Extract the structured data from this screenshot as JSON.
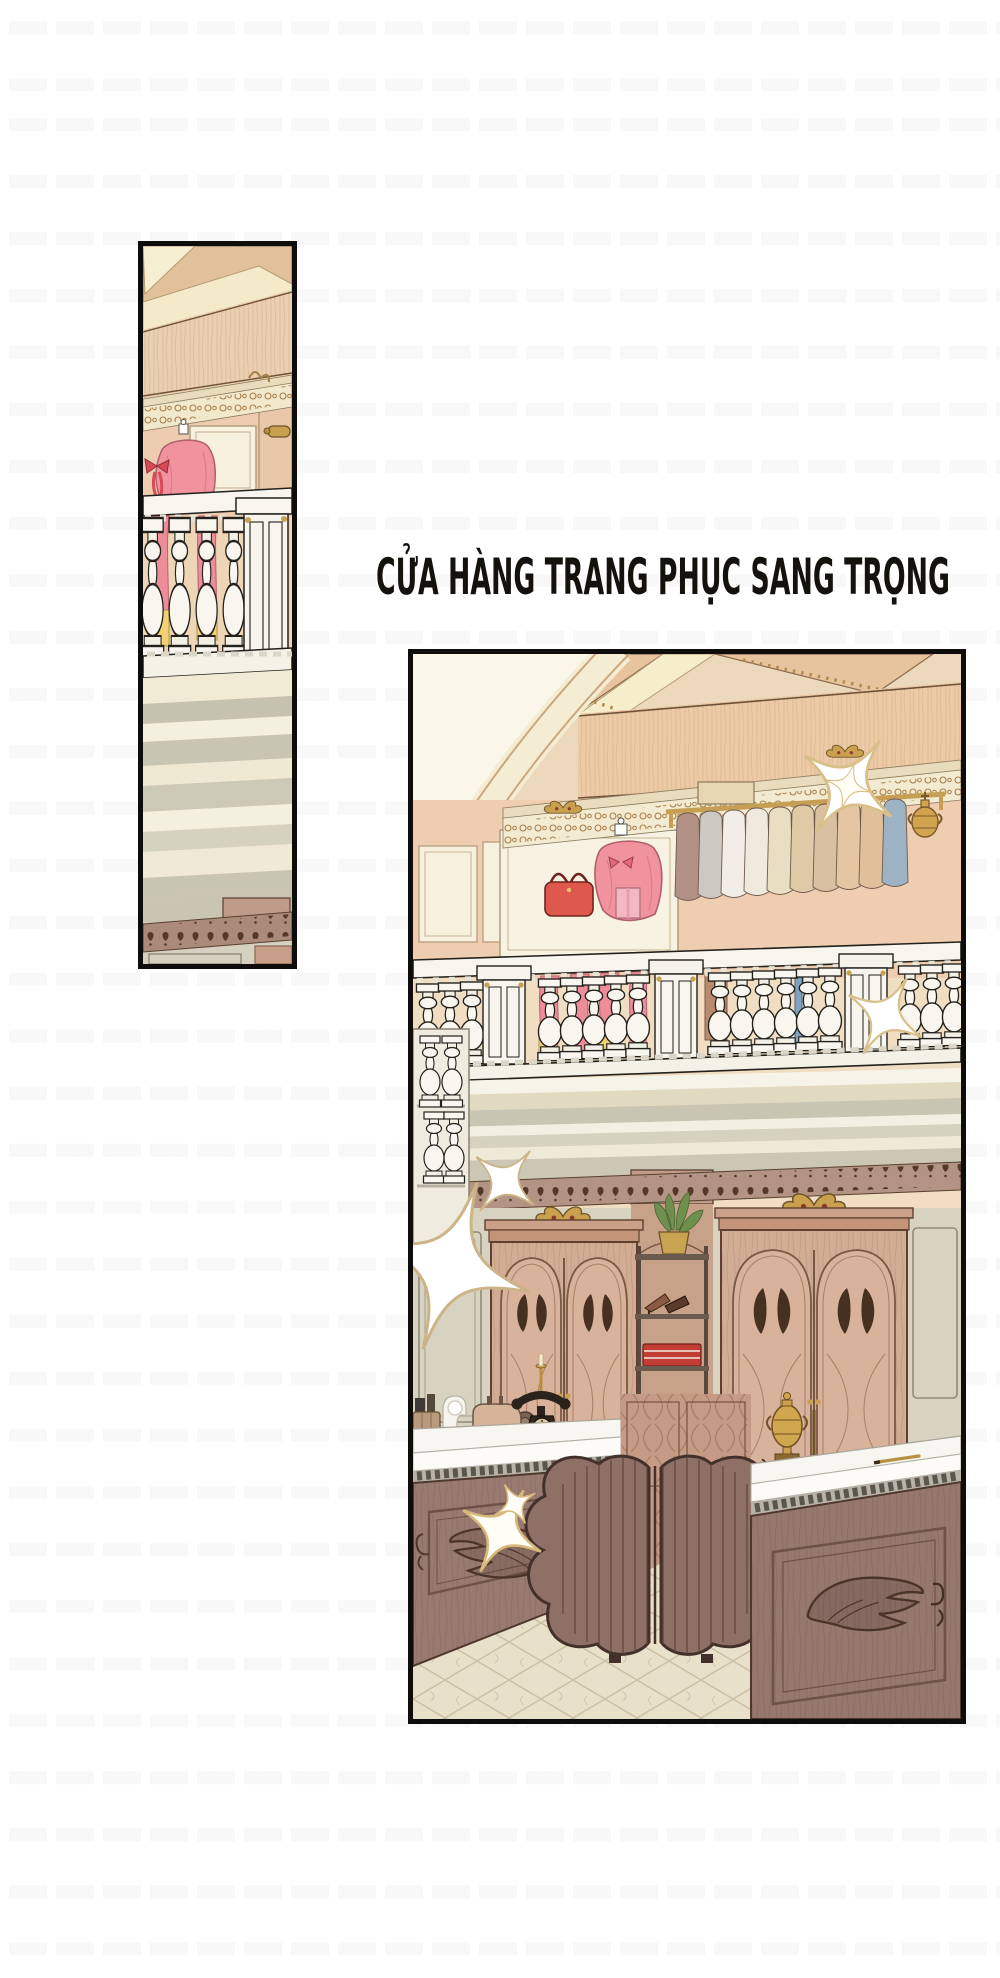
{
  "page": {
    "kind": "manhwa-page",
    "background": "#ffffff",
    "watermark": {
      "style": "faint repeated glyph rows",
      "color": "rgba(0,0,0,0.035)"
    }
  },
  "caption": {
    "text": "CỬA HÀNG TRANG PHỤC SANG TRỌNG"
  },
  "panels": {
    "left": {
      "alt": "Tall narrow panel: slice of boutique upper gallery - ceiling beams, gilt cornice, mannequin in pink dress behind a white balustrade with pink drapes, molding bands and carved cornice below"
    },
    "main": {
      "alt": "Luxury clothing store interior: vaulted cream ceiling, upper gallery with pink-dressed mannequin, red handbag, brass rack of folded garments, white balustrade, two carved wooden wardrobes with butterfly doors, display shelf with plant, shoes and folded red and blue clothes, wooden counters with white marble tops, antique telephone, sewing machine, golden urn, flower-shaped wooden screen, sparkles, tiled floor"
    }
  },
  "icons": {
    "sparkle": "four-point star sparkle"
  },
  "palette": {
    "panel_border": "#0e0d0b",
    "ink_outline": "#23211c",
    "ceiling_cream": "#f5edd3",
    "ceiling_tan": "#e8c49e",
    "fascia_peach": "#eccaa6",
    "wall_peach": "#eecdb1",
    "panel_cream": "#f7f2e1",
    "gold": "#c9a14e",
    "dress_pink": "#f1939f",
    "drape_pink": "#ee8d9a",
    "hem_yellow": "#f2d173",
    "handbag_red": "#de584e",
    "baluster_white": "#f8f6ef",
    "stone_gray": "#c9c5b3",
    "cornice_brown": "#b29384",
    "wardrobe_wood": "#d3ac94",
    "carving_dark": "#46301f",
    "counter_wood": "#997a71",
    "counter_top": "#f7f6f0",
    "screen_wood": "#8f7066",
    "floor_beige": "#e9e0ca",
    "shelf_red": "#c23e35",
    "shelf_blue": "#46688c",
    "plant_green": "#6f8f4f",
    "sparkle_outline": "#d9c08a"
  }
}
